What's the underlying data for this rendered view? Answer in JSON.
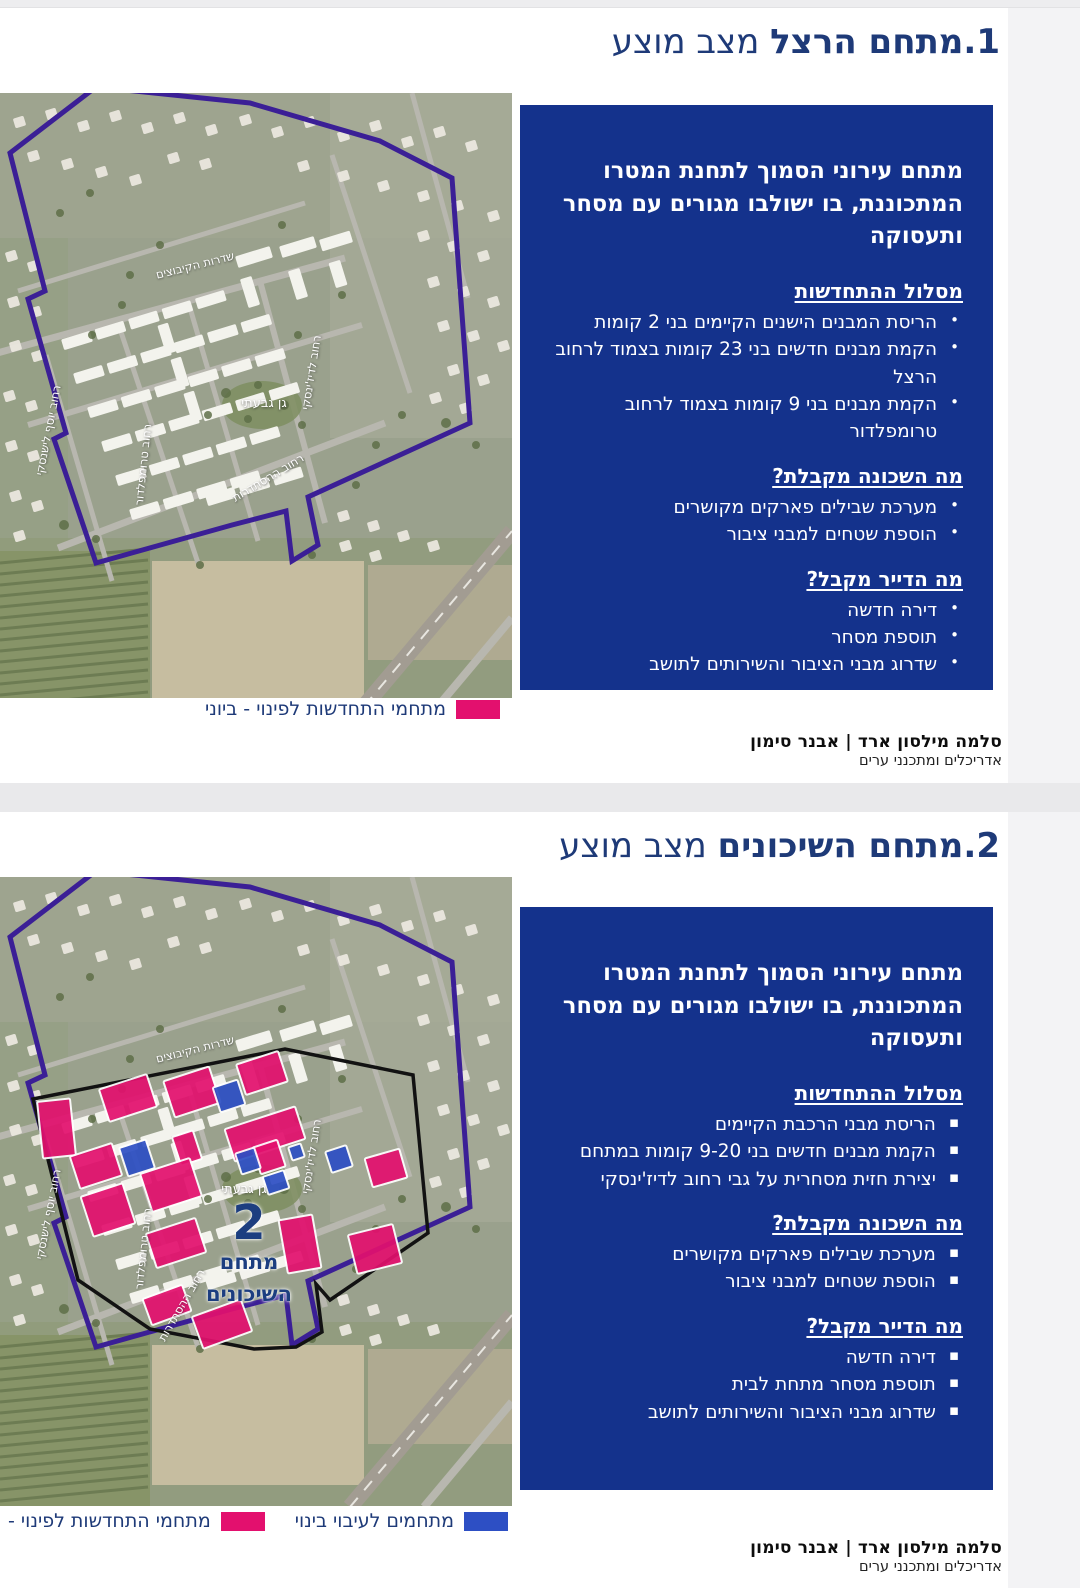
{
  "map_labels": {
    "kibbutzim": "שדרות הקיבוצים",
    "ladizhinsky_st": "רחוב לדיז'ינסקי",
    "trumpeldor_st": "רחוב טרומפלדור",
    "lishansky_st": "רחוב יוסף לישנסקי",
    "park": "גן גבעתי",
    "histadrut_st": "רחוב ההסתדרות"
  },
  "slides": [
    {
      "title_main": "1.מתחם הרצל",
      "title_status": "מצב מוצע",
      "panel": {
        "heading": "מתחם עירוני הסמוך לתחנת המטרו המתכוננת, בו ישולבו מגורים עם מסחר ותעסוקה",
        "bullet_char": "•",
        "sections": [
          {
            "title": "מסלול ההתחדשות",
            "bullets": [
              "הריסת המבנים הישנים הקיימים בני 2 קומות",
              "הקמת מבנים חדשים בני 23 קומות בצמוד לרחוב הרצל",
              "הקמת מבנים בני 9 קומות בצמוד לרחוב טרומפלדור"
            ]
          },
          {
            "title": "מה השכונה מקבלת?",
            "bullets": [
              "מערכת שבילים פארקים מקושרים",
              "הוספת שטחים למבני ציבור"
            ]
          },
          {
            "title": "מה הדייר מקבל?",
            "bullets": [
              "דירה חדשה",
              "תוספת מסחר",
              "שדרוג מבני הציבור והשירותים לתושב"
            ]
          }
        ]
      },
      "legend": [
        {
          "label": "מתחמי התחדשות לפינוי - ביוני",
          "color_key": "legend_pink"
        }
      ]
    },
    {
      "title_main": "2.מתחם השיכונים",
      "title_status": "מצב מוצע",
      "area_badge": {
        "number": "2",
        "line1": "מתחם",
        "line2": "השיכונים"
      },
      "panel": {
        "heading": "מתחם עירוני הסמוך לתחנת המטרו המתכוננת, בו ישולבו מגורים עם מסחר ותעסוקה",
        "bullet_char": "▪",
        "sections": [
          {
            "title": "מסלול ההתחדשות",
            "bullets": [
              "הריסת מבני הרכבת הקיימים",
              "הקמת מבנים חדשים בני 9-20 קומות במתחם",
              "יצירת חזית מסחרית על גבי רחוב לדיז'ינסקי"
            ]
          },
          {
            "title": "מה השכונה מקבלת?",
            "bullets": [
              "מערכת שבילים פארקים מקושרים",
              "הוספת שטחים למבני ציבור"
            ]
          },
          {
            "title": "מה הדייר מקבל?",
            "bullets": [
              "דירה חדשה",
              "תוספת מסחר מתחת לבית",
              "שדרוג מבני הציבור והשירותים לתושב"
            ]
          }
        ]
      },
      "legend": [
        {
          "label": "מתחמים לעיבוי בינוי",
          "color_key": "legend_blue"
        },
        {
          "label": "מתחמי התחדשות לפינוי -",
          "color_key": "legend_pink"
        }
      ]
    }
  ],
  "footer": {
    "brand": "סלמה מילסון ארד | אבנר סימון",
    "subtitle": "אדריכלים ומתכנני ערים"
  },
  "colors": {
    "title_navy": "#1e3a78",
    "panel_blue": "#14328c",
    "legend_pink": "#e3106e",
    "legend_blue": "#2d4fc4",
    "boundary_purple": "#3b1f96",
    "boundary_black": "#121212",
    "badge_navy": "#1c3e80"
  }
}
